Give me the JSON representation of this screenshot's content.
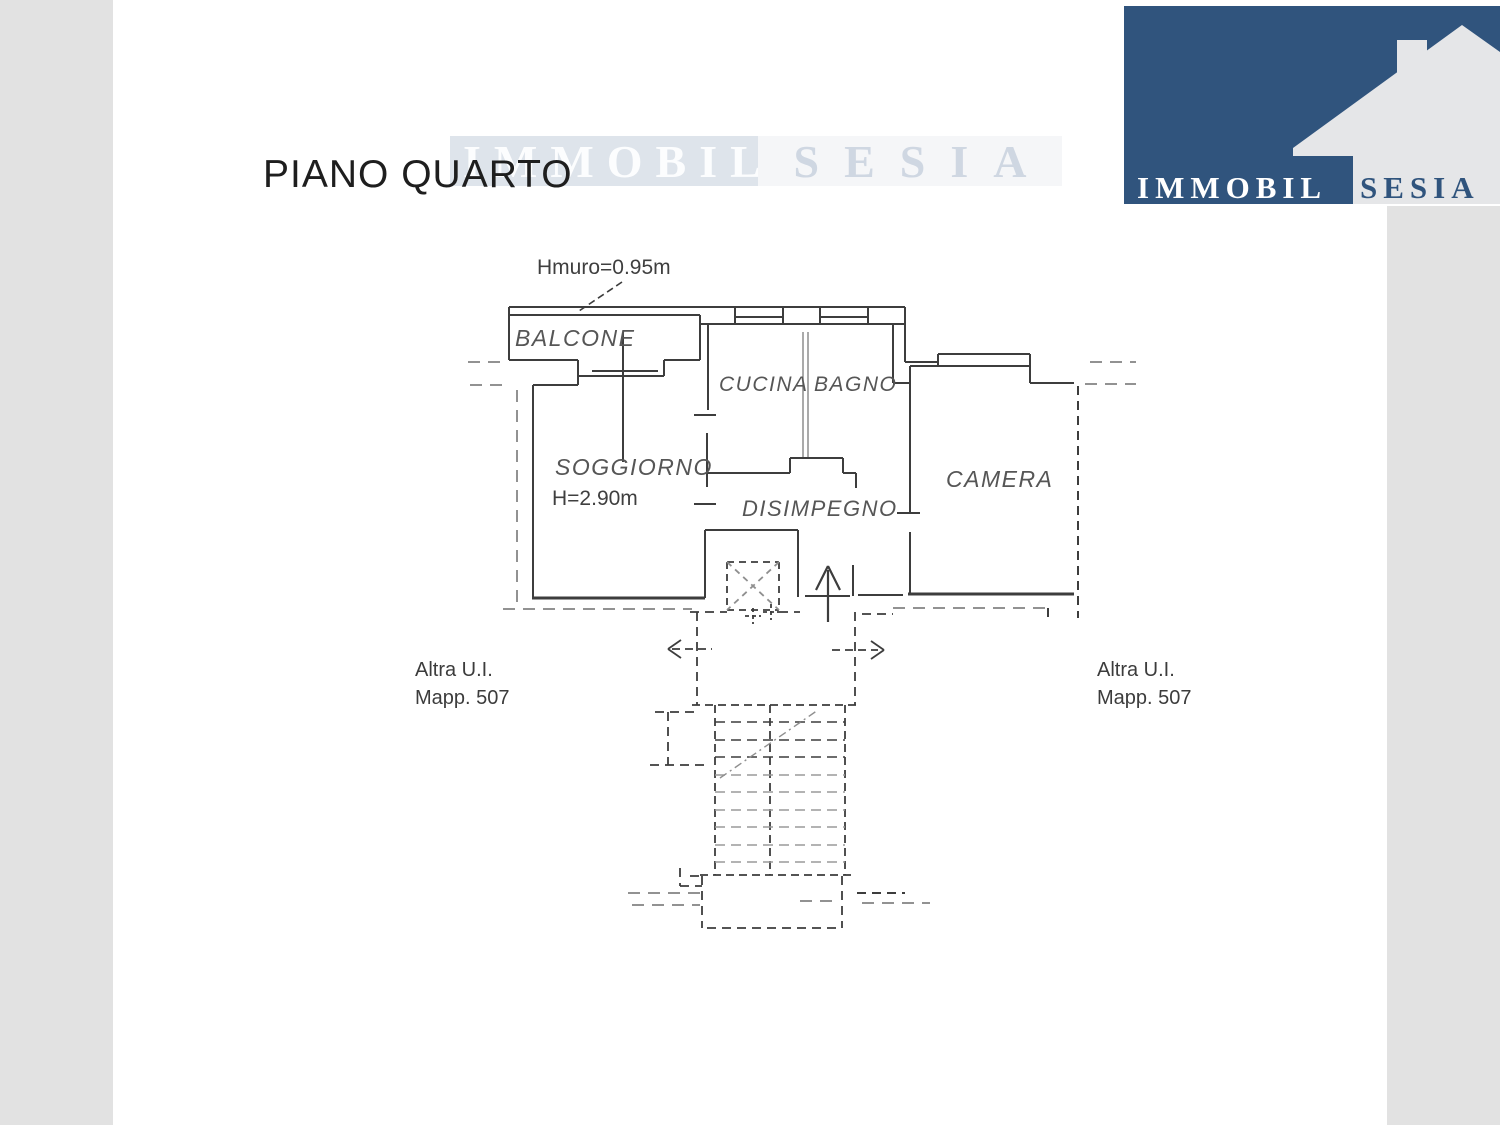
{
  "page": {
    "title": "PIANO QUARTO"
  },
  "branding": {
    "watermark": {
      "part1": "IMMOBIL",
      "part2": "SESIA"
    },
    "logo": {
      "part1": "IMMOBIL",
      "part2": "SESIA"
    }
  },
  "plan": {
    "annotations": {
      "wall_height": "Hmuro=0.95m",
      "ceiling_height": "H=2.90m"
    },
    "rooms": {
      "balcone": "BALCONE",
      "cucina": "CUCINA",
      "bagno": "BAGNO",
      "soggiorno": "SOGGIORNO",
      "disimpegno": "DISIMPEGNO",
      "camera": "CAMERA"
    },
    "adjacent_units": {
      "left": {
        "line1": "Altra U.I.",
        "line2": "Mapp. 507"
      },
      "right": {
        "line1": "Altra U.I.",
        "line2": "Mapp. 507"
      }
    }
  },
  "colors": {
    "logo_blue": "#30547d",
    "logo_house_gray": "#e5e6e8",
    "margin_band_gray": "#e2e2e2",
    "watermark_bg": "#dee4eb",
    "watermark_text": "#cfd7e2",
    "plan_line_dark": "#3d3d3d",
    "plan_line_gray": "#929292"
  }
}
